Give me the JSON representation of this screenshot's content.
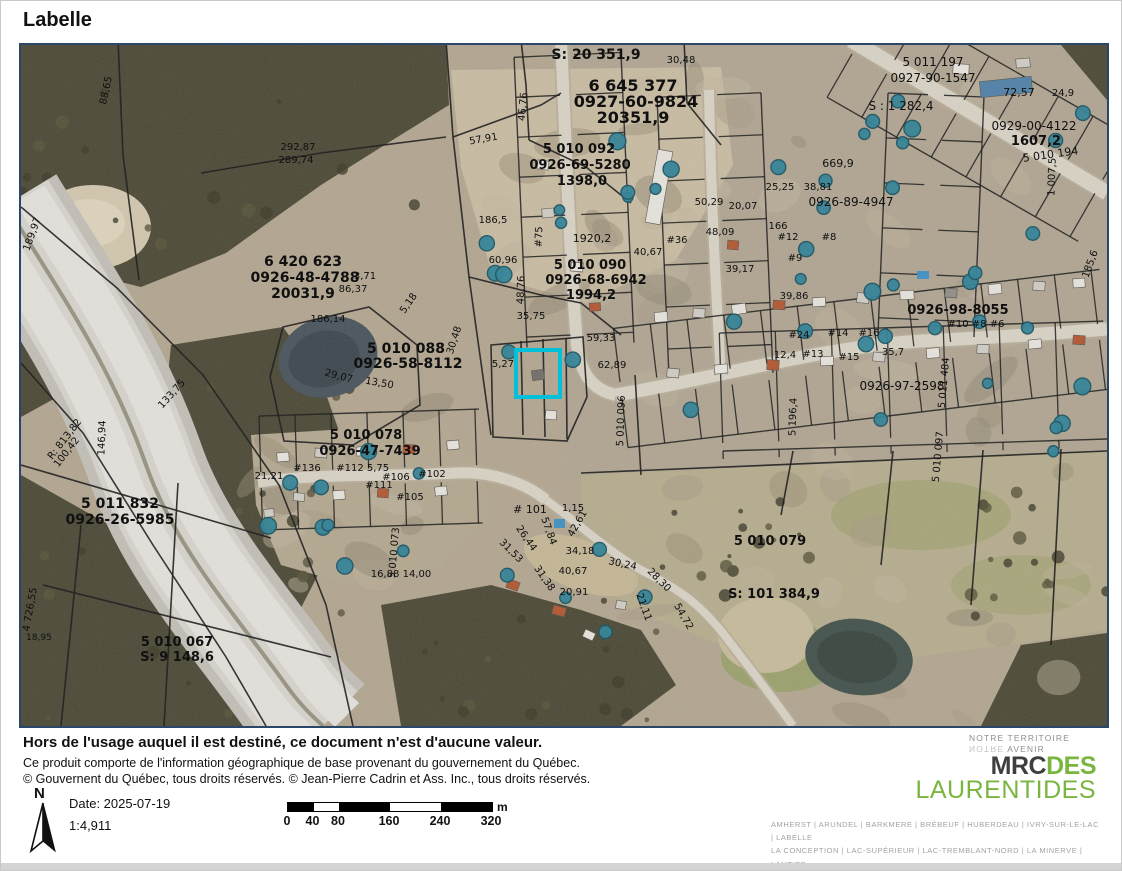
{
  "title": "Labelle",
  "colors": {
    "selection_cyan": "#00c0da",
    "map_border_navy": "#2a4668",
    "brand_green": "#7ab63f",
    "pool_teal": "#2e8196"
  },
  "map": {
    "selected_parcel": {
      "x": 497,
      "y": 307,
      "w": 40,
      "h": 43
    },
    "labels": [
      {
        "t": "S: 20 351,9",
        "x": 575,
        "y": 14,
        "s": 14
      },
      {
        "t": "6 645 377",
        "x": 612,
        "y": 46,
        "s": 16
      },
      {
        "t": "0927-60-9824",
        "x": 615,
        "y": 62,
        "s": 16
      },
      {
        "t": "20351,9",
        "x": 612,
        "y": 78,
        "s": 16
      },
      {
        "t": "30,48",
        "x": 660,
        "y": 18,
        "s": 10
      },
      {
        "t": "88,65",
        "x": 88,
        "y": 46,
        "s": 10,
        "r": -78
      },
      {
        "t": "189,97",
        "x": 14,
        "y": 190,
        "s": 10,
        "r": -70
      },
      {
        "t": "292,87",
        "x": 277,
        "y": 105,
        "s": 10
      },
      {
        "t": "289,74",
        "x": 275,
        "y": 118,
        "s": 10
      },
      {
        "t": "6 420 623",
        "x": 282,
        "y": 221,
        "s": 14
      },
      {
        "t": "0926-48-4788",
        "x": 284,
        "y": 237,
        "s": 14
      },
      {
        "t": "20031,9",
        "x": 282,
        "y": 253,
        "s": 14
      },
      {
        "t": "86,37",
        "x": 332,
        "y": 247,
        "s": 10
      },
      {
        "t": "3,71",
        "x": 344,
        "y": 234,
        "s": 10
      },
      {
        "t": "5,18",
        "x": 390,
        "y": 260,
        "s": 10,
        "r": -55
      },
      {
        "t": "186,14",
        "x": 307,
        "y": 277,
        "s": 10
      },
      {
        "t": "5 010 088",
        "x": 385,
        "y": 308,
        "s": 14
      },
      {
        "t": "0926-58-8112",
        "x": 387,
        "y": 323,
        "s": 14
      },
      {
        "t": "29,07",
        "x": 317,
        "y": 334,
        "s": 10,
        "r": 15
      },
      {
        "t": "13,50",
        "x": 358,
        "y": 341,
        "s": 10,
        "r": 10
      },
      {
        "t": "57,91",
        "x": 463,
        "y": 97,
        "s": 10,
        "r": -10
      },
      {
        "t": "46,76",
        "x": 505,
        "y": 62,
        "s": 10,
        "r": -85
      },
      {
        "t": "186,5",
        "x": 472,
        "y": 178,
        "s": 10
      },
      {
        "t": "60,96",
        "x": 482,
        "y": 218,
        "s": 10
      },
      {
        "t": "5 010 092",
        "x": 558,
        "y": 108,
        "s": 13
      },
      {
        "t": "0926-69-5280",
        "x": 559,
        "y": 124,
        "s": 13
      },
      {
        "t": "1398,0",
        "x": 561,
        "y": 140,
        "s": 13
      },
      {
        "t": "1920,2",
        "x": 571,
        "y": 197,
        "s": 11
      },
      {
        "t": "5 010 090",
        "x": 569,
        "y": 224,
        "s": 13
      },
      {
        "t": "0926-68-6942",
        "x": 575,
        "y": 239,
        "s": 13
      },
      {
        "t": "1994,2",
        "x": 570,
        "y": 254,
        "s": 13
      },
      {
        "t": "#75",
        "x": 521,
        "y": 192,
        "s": 10,
        "r": -88
      },
      {
        "t": "48,76",
        "x": 503,
        "y": 245,
        "s": 10,
        "r": -88
      },
      {
        "t": "35,75",
        "x": 510,
        "y": 274,
        "s": 10
      },
      {
        "t": "30,48",
        "x": 436,
        "y": 296,
        "s": 10,
        "r": -72
      },
      {
        "t": "5,27",
        "x": 482,
        "y": 322,
        "s": 10
      },
      {
        "t": "59,33",
        "x": 580,
        "y": 296,
        "s": 10
      },
      {
        "t": "62,89",
        "x": 591,
        "y": 323,
        "s": 10
      },
      {
        "t": "5 010 096",
        "x": 603,
        "y": 376,
        "s": 10,
        "r": -88
      },
      {
        "t": "5 196,4",
        "x": 775,
        "y": 372,
        "s": 10,
        "r": -88
      },
      {
        "t": "5 010 097",
        "x": 920,
        "y": 412,
        "s": 10,
        "r": -85
      },
      {
        "t": "5 011 832",
        "x": 99,
        "y": 463,
        "s": 14
      },
      {
        "t": "0926-26-5985",
        "x": 99,
        "y": 479,
        "s": 14
      },
      {
        "t": "R: 813,82",
        "x": 46,
        "y": 396,
        "s": 10,
        "r": -52
      },
      {
        "t": "100,42",
        "x": 48,
        "y": 409,
        "s": 10,
        "r": -52
      },
      {
        "t": "146,94",
        "x": 84,
        "y": 393,
        "s": 10,
        "r": -88
      },
      {
        "t": "133,75",
        "x": 153,
        "y": 351,
        "s": 10,
        "r": -48
      },
      {
        "t": "4 726,55",
        "x": 12,
        "y": 565,
        "s": 10,
        "r": -80
      },
      {
        "t": "18,95",
        "x": 18,
        "y": 595,
        "s": 9
      },
      {
        "t": "5 010 067",
        "x": 156,
        "y": 601,
        "s": 13
      },
      {
        "t": "S: 9 148,6",
        "x": 156,
        "y": 616,
        "s": 13
      },
      {
        "t": "16,88  14,00",
        "x": 380,
        "y": 532,
        "s": 10
      },
      {
        "t": "5 010 073",
        "x": 376,
        "y": 508,
        "s": 10,
        "r": -85
      },
      {
        "t": "5 010 078",
        "x": 345,
        "y": 394,
        "s": 13
      },
      {
        "t": "0926-47-7439",
        "x": 349,
        "y": 410,
        "s": 13
      },
      {
        "t": "21,21",
        "x": 248,
        "y": 434,
        "s": 10
      },
      {
        "t": "#136",
        "x": 286,
        "y": 426,
        "s": 10
      },
      {
        "t": "#112",
        "x": 329,
        "y": 426,
        "s": 10
      },
      {
        "t": "5,75",
        "x": 357,
        "y": 426,
        "s": 10
      },
      {
        "t": "#106",
        "x": 375,
        "y": 435,
        "s": 10
      },
      {
        "t": "#102",
        "x": 411,
        "y": 432,
        "s": 10
      },
      {
        "t": "#111",
        "x": 358,
        "y": 443,
        "s": 10
      },
      {
        "t": "#105",
        "x": 389,
        "y": 455,
        "s": 10
      },
      {
        "t": "# 101",
        "x": 509,
        "y": 468,
        "s": 11
      },
      {
        "t": "1,15",
        "x": 552,
        "y": 466,
        "s": 10
      },
      {
        "t": "42,61",
        "x": 559,
        "y": 480,
        "s": 10,
        "r": -60
      },
      {
        "t": "57,84",
        "x": 525,
        "y": 487,
        "s": 10,
        "r": 70
      },
      {
        "t": "26,44",
        "x": 503,
        "y": 495,
        "s": 10,
        "r": 55
      },
      {
        "t": "31,53",
        "x": 488,
        "y": 508,
        "s": 10,
        "r": 45
      },
      {
        "t": "34,18",
        "x": 559,
        "y": 509,
        "s": 10
      },
      {
        "t": "40,67",
        "x": 552,
        "y": 529,
        "s": 10
      },
      {
        "t": "31,38",
        "x": 521,
        "y": 535,
        "s": 10,
        "r": 55
      },
      {
        "t": "20,91",
        "x": 553,
        "y": 550,
        "s": 10
      },
      {
        "t": "30,24",
        "x": 601,
        "y": 522,
        "s": 10,
        "r": 12
      },
      {
        "t": "28,30",
        "x": 636,
        "y": 537,
        "s": 10,
        "r": 45
      },
      {
        "t": "21,11",
        "x": 620,
        "y": 563,
        "s": 10,
        "r": 70
      },
      {
        "t": "54,72",
        "x": 660,
        "y": 573,
        "s": 10,
        "r": 60
      },
      {
        "t": "5 010 079",
        "x": 749,
        "y": 500,
        "s": 13
      },
      {
        "t": "S: 101 384,9",
        "x": 753,
        "y": 553,
        "s": 13
      },
      {
        "t": "50,29",
        "x": 688,
        "y": 160,
        "s": 10
      },
      {
        "t": "48,09",
        "x": 699,
        "y": 190,
        "s": 10
      },
      {
        "t": "#36",
        "x": 656,
        "y": 198,
        "s": 10
      },
      {
        "t": "40,67",
        "x": 627,
        "y": 210,
        "s": 10
      },
      {
        "t": "20,07",
        "x": 722,
        "y": 164,
        "s": 10
      },
      {
        "t": "166",
        "x": 757,
        "y": 184,
        "s": 10
      },
      {
        "t": "#12",
        "x": 767,
        "y": 195,
        "s": 10
      },
      {
        "t": "#8",
        "x": 808,
        "y": 195,
        "s": 10
      },
      {
        "t": "#9",
        "x": 774,
        "y": 216,
        "s": 10
      },
      {
        "t": "39,17",
        "x": 719,
        "y": 227,
        "s": 10
      },
      {
        "t": "25,25",
        "x": 759,
        "y": 145,
        "s": 10
      },
      {
        "t": "38,81",
        "x": 797,
        "y": 145,
        "s": 10
      },
      {
        "t": "669,9",
        "x": 817,
        "y": 122,
        "s": 11
      },
      {
        "t": "0926-89-4947",
        "x": 830,
        "y": 161,
        "s": 12
      },
      {
        "t": "39,86",
        "x": 773,
        "y": 254,
        "s": 10
      },
      {
        "t": "#24",
        "x": 778,
        "y": 293,
        "s": 10
      },
      {
        "t": "#14",
        "x": 817,
        "y": 291,
        "s": 10
      },
      {
        "t": "#16",
        "x": 848,
        "y": 291,
        "s": 10
      },
      {
        "t": "#15",
        "x": 828,
        "y": 315,
        "s": 10
      },
      {
        "t": "#13",
        "x": 792,
        "y": 312,
        "s": 10
      },
      {
        "t": "12,4",
        "x": 764,
        "y": 313,
        "s": 10
      },
      {
        "t": "35,7",
        "x": 872,
        "y": 310,
        "s": 10
      },
      {
        "t": "0926-98-8055",
        "x": 937,
        "y": 269,
        "s": 13
      },
      {
        "t": "#10 #8 #6",
        "x": 955,
        "y": 282,
        "s": 10
      },
      {
        "t": "0926-97-2598",
        "x": 881,
        "y": 345,
        "s": 12
      },
      {
        "t": "5 011 484",
        "x": 926,
        "y": 338,
        "s": 10,
        "r": -85
      },
      {
        "t": "S : 1 282,4",
        "x": 880,
        "y": 65,
        "s": 12
      },
      {
        "t": "5 011 197",
        "x": 912,
        "y": 21,
        "s": 12
      },
      {
        "t": "0927-90-1547",
        "x": 912,
        "y": 37,
        "s": 12
      },
      {
        "t": "72,57",
        "x": 998,
        "y": 51,
        "s": 11
      },
      {
        "t": "24,9",
        "x": 1042,
        "y": 51,
        "s": 10
      },
      {
        "t": "0929-00-4122",
        "x": 1013,
        "y": 85,
        "s": 12
      },
      {
        "t": "1607,2",
        "x": 1015,
        "y": 100,
        "s": 13
      },
      {
        "t": "5 010 194",
        "x": 1030,
        "y": 113,
        "s": 11,
        "r": -8
      },
      {
        "t": "1 007,5",
        "x": 1034,
        "y": 132,
        "s": 10,
        "r": -88
      },
      {
        "t": "185,6",
        "x": 1072,
        "y": 220,
        "s": 10,
        "r": -70
      }
    ]
  },
  "footer": {
    "disclaimer": "Hors de l'usage auquel il est destiné, ce document n'est d'aucune valeur.",
    "credit1": "Ce produit comporte de l'information géographique de base provenant du gouvernement du Québec.",
    "credit2": "© Gouvernent du Québec, tous droits réservés. © Jean-Pierre Cadrin et Ass. Inc., tous droits réservés.",
    "north_label": "N",
    "date_label": "Date: 2025-07-19",
    "scale_ratio": "1:4,911",
    "scalebar": {
      "ticks": [
        "0",
        "40",
        "80",
        "160",
        "240",
        "320"
      ],
      "unit": "m"
    },
    "logo": {
      "tagline1": "NOTRE TERRITOIRE",
      "tagline2_mirrored": "NOTRE",
      "tagline2_rest": " AVENIR",
      "brand_dark": "MRC",
      "brand_green_1": "DES",
      "brand_green_2": "LAURENTIDES"
    },
    "municipalities": [
      "AMHERST | ARUNDEL | BARKMERE | BRÉBEUF | HUBERDEAU | IVRY-SUR-LE-LAC | LABELLE",
      "LA CONCEPTION | LAC-SUPÉRIEUR | LAC-TREMBLANT-NORD | LA MINERVE | LANTIER",
      "MONT-BLANC | MONTCALM | MONT-TREMBLANT | SAINTE-AGATHE-DES-MONTS",
      "SAINTE-LUCIE-DES-LAURENTIDES | VAL-DAVID | VAL-DES-LACS | VAL-MORIN"
    ]
  }
}
